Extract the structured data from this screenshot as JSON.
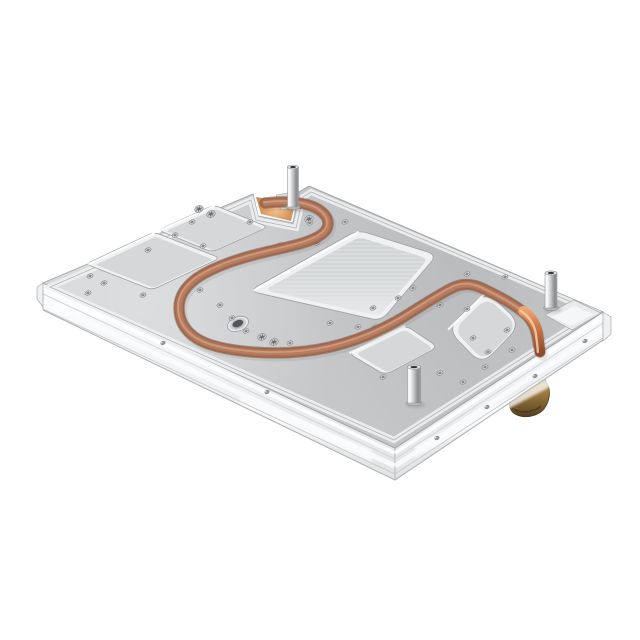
{
  "meta": {
    "type": "product-photo",
    "subject": "aluminum-cold-plate-with-embedded-copper-heat-pipe",
    "background": "#ffffff",
    "canvas": [
      640,
      640
    ]
  },
  "colors": {
    "plate_light": "#d4d6d8",
    "plate_mid": "#c7c9cb",
    "plate_dark": "#c0c2c4",
    "plate_edge_hi": "#eef0f2",
    "outline": "#a5a7a9",
    "step_line": "#b4b6b8",
    "pocket_wall": "#eff1f2",
    "pocket_floor": "#d5d7d9",
    "pocket_floor_lo": "#cfd1d3",
    "pocket_floor_hi": "#ecedef",
    "streak": "#e7e9ea",
    "tube_dark": "#7d5038",
    "tube_main": "#996349",
    "tube_mid": "#ab7154",
    "tube_lite": "#b87e61",
    "tube_hi": "#cf9a7c",
    "glow_hot": "#f7c693",
    "glow_cool": "#bd7c50",
    "drop_hot": "#f2a76e",
    "drop_mid": "#c87447",
    "drop_dark": "#8a4a2b",
    "chrome_hi": "#fafbfc",
    "chrome_mid": "#c3c5c7",
    "chrome_dark": "#898b8e",
    "rail_top": "#fdfdfe",
    "rail_bot": "#e1e3e5",
    "rail_line": "#c6c8ca",
    "brass_hi": "#c9a75f",
    "brass_mid": "#a07d3e",
    "brass_dark": "#6a5128",
    "brass_deep": "#4f3d1f",
    "hole_ring": "#dcdee0",
    "hole_core": "#85878a",
    "hole_rim": "#8a8c8e"
  },
  "plate": {
    "outline": [
      [
        43,
        283
      ],
      [
        253,
        194
      ],
      [
        258,
        216
      ],
      [
        293,
        223
      ],
      [
        299,
        192
      ],
      [
        309,
        186
      ],
      [
        603,
        312
      ],
      [
        395,
        448
      ]
    ],
    "inset": [
      [
        50,
        287
      ],
      [
        251,
        200
      ],
      [
        256,
        220
      ],
      [
        296,
        228
      ],
      [
        303,
        197
      ],
      [
        311,
        192
      ],
      [
        595,
        312
      ],
      [
        394,
        440
      ]
    ]
  },
  "rails": {
    "left": {
      "face": [
        [
          43,
          283
        ],
        [
          395,
          448
        ],
        [
          395,
          480
        ],
        [
          43,
          310
        ]
      ],
      "top": [
        [
          43,
          283
        ],
        [
          395,
          448
        ]
      ],
      "lines": [
        {
          "dy": 5,
          "c": "#ffffff",
          "w": 3.5,
          "o": 0.9
        },
        {
          "dy": 11,
          "c": "#d2d4d6",
          "w": 1,
          "o": 1
        },
        {
          "dy": 18,
          "c": "#fbfcfd",
          "w": 5,
          "o": 0.9
        },
        {
          "dy": 26,
          "c": "#c6c8ca",
          "w": 1,
          "o": 0.9
        }
      ],
      "bottom": [
        [
          43,
          310
        ],
        [
          395,
          480
        ]
      ],
      "streaks": [
        [
          [
            55,
            302
          ],
          [
            208,
            320
          ],
          [
            208,
            331
          ],
          [
            55,
            313
          ]
        ],
        [
          [
            240,
            395
          ],
          [
            372,
            450
          ],
          [
            372,
            462
          ],
          [
            240,
            407
          ]
        ]
      ],
      "holes": [
        [
          163,
          343
        ],
        [
          267,
          392
        ]
      ]
    },
    "right": {
      "face": [
        [
          395,
          448
        ],
        [
          603,
          312
        ],
        [
          603,
          340
        ],
        [
          395,
          480
        ]
      ],
      "top": [
        [
          395,
          448
        ],
        [
          603,
          312
        ]
      ],
      "lines": [
        {
          "dy": 5,
          "c": "#ffffff",
          "w": 3.5,
          "o": 0.9
        },
        {
          "dy": 11,
          "c": "#d2d4d6",
          "w": 1,
          "o": 1
        },
        {
          "dy": 18,
          "c": "#fbfcfd",
          "w": 5,
          "o": 0.9
        },
        {
          "dy": 26,
          "c": "#c6c8ca",
          "w": 1,
          "o": 0.9
        }
      ],
      "bottom": [
        [
          395,
          480
        ],
        [
          603,
          340
        ]
      ],
      "streaks": [
        [
          [
            415,
            446
          ],
          [
            565,
            369
          ],
          [
            565,
            379
          ],
          [
            415,
            458
          ]
        ]
      ],
      "holes": [
        [
          585,
          341
        ],
        [
          535,
          376
        ],
        [
          487,
          407
        ],
        [
          437,
          438
        ]
      ]
    },
    "caps": [
      [
        [
          43,
          283
        ],
        [
          37,
          287
        ],
        [
          37,
          299
        ],
        [
          43,
          307
        ]
      ],
      [
        [
          603,
          312
        ],
        [
          611,
          317
        ],
        [
          611,
          334
        ],
        [
          603,
          341
        ]
      ]
    ]
  },
  "pockets": [
    {
      "name": "pocket-upper-left-large",
      "quad": [
        [
          86,
          264
        ],
        [
          154,
          232
        ],
        [
          220,
          258
        ],
        [
          152,
          290
        ]
      ],
      "r": 6,
      "inset": 0.12,
      "streaks": false
    },
    {
      "name": "pocket-upper-left-small",
      "quad": [
        [
          158,
          230
        ],
        [
          214,
          205
        ],
        [
          268,
          227
        ],
        [
          212,
          252
        ]
      ],
      "r": 6,
      "inset": 0.12,
      "streaks": false
    },
    {
      "name": "pocket-center-large",
      "quad": [
        [
          249,
          291
        ],
        [
          358,
          230
        ],
        [
          437,
          255
        ],
        [
          381,
          321
        ]
      ],
      "r": 10,
      "inset": 0.13,
      "streaks": true
    },
    {
      "name": "pocket-bottom-small",
      "quad": [
        [
          348,
          353
        ],
        [
          405,
          325
        ],
        [
          438,
          347
        ],
        [
          385,
          375
        ]
      ],
      "r": 8,
      "inset": 0.14,
      "streaks": false
    },
    {
      "name": "pocket-right-rounded",
      "quad": [
        [
          447,
          329
        ],
        [
          486,
          291
        ],
        [
          521,
          324
        ],
        [
          482,
          365
        ]
      ],
      "r": 16,
      "inset": 0.14,
      "streaks": false
    }
  ],
  "right_notch": {
    "outer": [
      [
        545,
        315
      ],
      [
        574,
        300
      ],
      [
        601,
        313
      ],
      [
        572,
        330
      ]
    ],
    "floor": [
      [
        552,
        317
      ],
      [
        574,
        306
      ],
      [
        594,
        314
      ],
      [
        571,
        326
      ]
    ]
  },
  "top_notch": {
    "glow": [
      [
        256,
        197
      ],
      [
        261,
        214
      ],
      [
        291,
        221
      ],
      [
        295,
        204
      ]
    ],
    "tab": [
      [
        276,
        195
      ],
      [
        299,
        191
      ],
      [
        301,
        206
      ],
      [
        281,
        210
      ]
    ]
  },
  "tube": {
    "path": "M265,203 C290,200 312,203 322,212 C330,219 330,228 322,234 C312,242 292,246 270,251 C240,258 215,266 197,278 C185,287 179,296 179,308 C179,320 184,330 196,338 C208,346 228,350 252,352 C278,354 304,353 330,347 C356,341 380,331 402,318 C420,307 436,296 452,288 C462,283 472,283 484,289 C498,296 512,303 522,311 C530,317 535,325 537,336 C538,342 539,348 540,352",
    "drop_path": "M523,311 C531,316 536,324 538,333 C539,341 540,347 540,352",
    "strokes": [
      {
        "w": 12,
        "c": "#5b4536",
        "o": 0.1,
        "dx": 2,
        "dy": 2.5
      },
      {
        "w": 11.5,
        "c": "#7d5038",
        "o": 0.55,
        "dx": 0,
        "dy": 0
      },
      {
        "w": 9.5,
        "c": "#996349",
        "o": 1,
        "dx": 0,
        "dy": 0
      },
      {
        "w": 7.5,
        "c": "#ab7154",
        "o": 1,
        "dx": 0,
        "dy": 0
      },
      {
        "w": 4.5,
        "c": "#b87e61",
        "o": 1,
        "dx": 0,
        "dy": 0
      },
      {
        "w": 1.8,
        "c": "#cf9a7c",
        "o": 0.95,
        "dx": -1,
        "dy": -0.8
      }
    ]
  },
  "standoffs": [
    {
      "cx": 293,
      "top": 167,
      "base": 207,
      "w": 11
    },
    {
      "cx": 551,
      "top": 273,
      "base": 308,
      "w": 12
    },
    {
      "cx": 414,
      "top": 367,
      "base": 403,
      "w": 13
    }
  ],
  "counterbore": {
    "cx": 238,
    "cy": 324,
    "rx": 11,
    "ry": 7,
    "mrx": 8.6,
    "mry": 5.4,
    "irx": 6,
    "iry": 3.8,
    "rot": -22
  },
  "holes": {
    "surface": [
      [
        90,
        276
      ],
      [
        104,
        283
      ],
      [
        143,
        295
      ],
      [
        148,
        250
      ],
      [
        175,
        235
      ],
      [
        192,
        222
      ],
      [
        203,
        246
      ],
      [
        200,
        290
      ],
      [
        220,
        305
      ],
      [
        232,
        318
      ],
      [
        246,
        331
      ],
      [
        290,
        343
      ],
      [
        250,
        222
      ],
      [
        280,
        245
      ],
      [
        310,
        223
      ],
      [
        345,
        222
      ],
      [
        317,
        243
      ],
      [
        358,
        327
      ],
      [
        330,
        323
      ],
      [
        373,
        308
      ],
      [
        398,
        298
      ],
      [
        375,
        327
      ],
      [
        413,
        288
      ],
      [
        440,
        305
      ],
      [
        467,
        274
      ],
      [
        505,
        277
      ],
      [
        467,
        309
      ],
      [
        488,
        352
      ],
      [
        473,
        338
      ],
      [
        512,
        350
      ],
      [
        485,
        367
      ],
      [
        507,
        330
      ],
      [
        440,
        373
      ],
      [
        417,
        382
      ],
      [
        463,
        382
      ],
      [
        383,
        377
      ],
      [
        88,
        293
      ]
    ],
    "rot": -22
  },
  "torx_screws": [
    [
      199,
      209
    ],
    [
      211,
      214
    ],
    [
      262,
      337
    ],
    [
      274,
      342
    ],
    [
      309,
      219
    ]
  ],
  "brass_fitting": {
    "body": "M508,393 C505,383 511,376 521,373 C532,370 543,374 547,383 C551,391 550,401 544,409 C537,417 524,419 515,414 C508,410 509,401 508,393 Z",
    "accent": "M514,377 C519,372 528,371 533,374 C529,378 520,380 514,377 Z"
  }
}
